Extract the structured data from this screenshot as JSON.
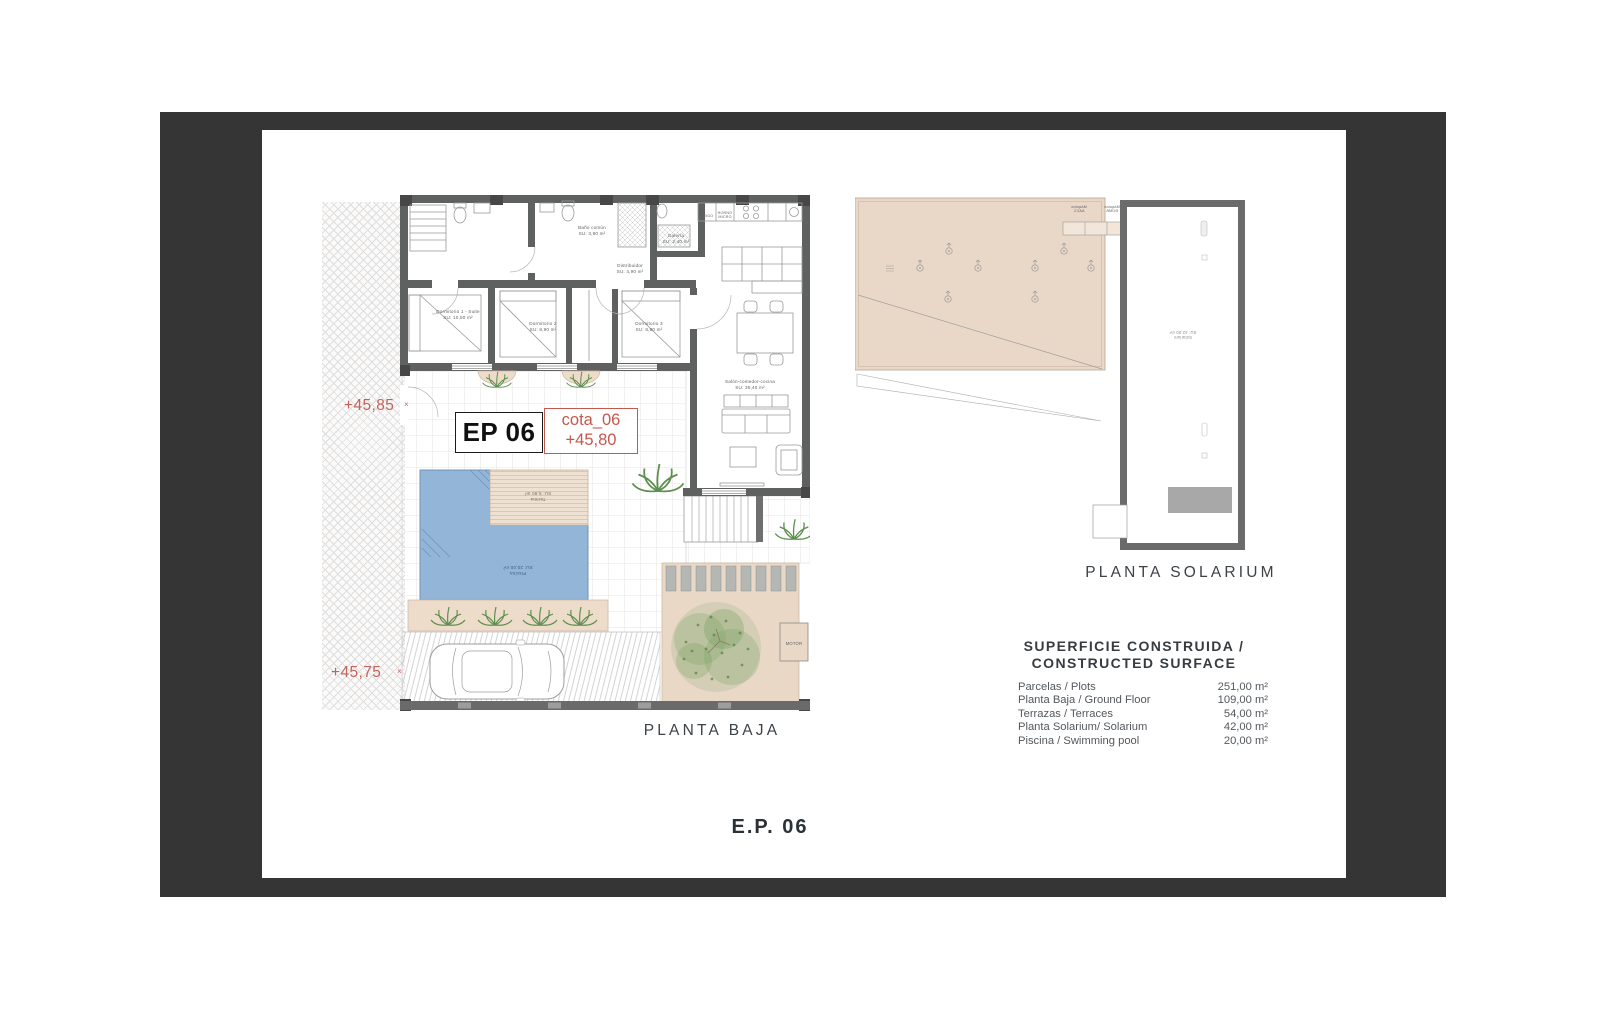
{
  "sheet": {
    "code_label": "E.P. 06"
  },
  "ground_floor": {
    "title": "PLANTA BAJA",
    "ep_code": "EP 06",
    "cota": {
      "name": "cota_06",
      "level": "+45,80"
    },
    "level_marks": {
      "upper": "+45,85",
      "lower": "+45,75",
      "mark": "×"
    },
    "rooms": [
      {
        "name": "Dormitorio 1 - Suite",
        "area": "SU: 10,50 m²"
      },
      {
        "name": "Dormitorio 2",
        "area": "SU: 8,90 m²"
      },
      {
        "name": "Dormitorio 3",
        "area": "SU: 8,90 m²"
      },
      {
        "name": "Baño común",
        "area": "SU: 3,90 m²"
      },
      {
        "name": "Galería",
        "area": "SU: 2,40 m²"
      },
      {
        "name": "Distribuidor",
        "area": "SU: 4,90 m²"
      },
      {
        "name": "Salón-comedor-cocina",
        "area": "SU: 35,40 m²"
      },
      {
        "name": "Piscina",
        "area": "SU: 20,00 m²"
      },
      {
        "name": "Tarima",
        "area": "SU: 9,80 m²"
      }
    ],
    "kitchen_labels": {
      "fridge": "FRIGO",
      "oven_line1": "HORNO",
      "oven_line2": "MICRO"
    },
    "motor_label": "MOTOR"
  },
  "solarium": {
    "title": "PLANTA SOLARIUM",
    "room": {
      "name": "Solarium",
      "area": "SU: 42,00 m²"
    },
    "machines": [
      {
        "line1": "Máquina",
        "line2": "AACC"
      },
      {
        "line1": "Máquina",
        "line2": "BOMB"
      }
    ]
  },
  "surface_table": {
    "title_line1": "SUPERFICIE CONSTRUIDA /",
    "title_line2": "CONSTRUCTED SURFACE",
    "rows": [
      {
        "label": "Parcelas / Plots",
        "value": "251,00 m²"
      },
      {
        "label": "Planta Baja / Ground Floor",
        "value": "109,00 m²"
      },
      {
        "label": "Terrazas / Terraces",
        "value": "54,00 m²"
      },
      {
        "label": "Planta Solarium/ Solarium",
        "value": "42,00 m²"
      },
      {
        "label": "Piscina / Swimming pool",
        "value": "20,00 m²"
      }
    ]
  },
  "colors": {
    "accent_red": "#c4584c",
    "wall_gray": "#5f6060",
    "roof_beige": "#e9d7c7",
    "pool_blue": "#92b5d8"
  }
}
